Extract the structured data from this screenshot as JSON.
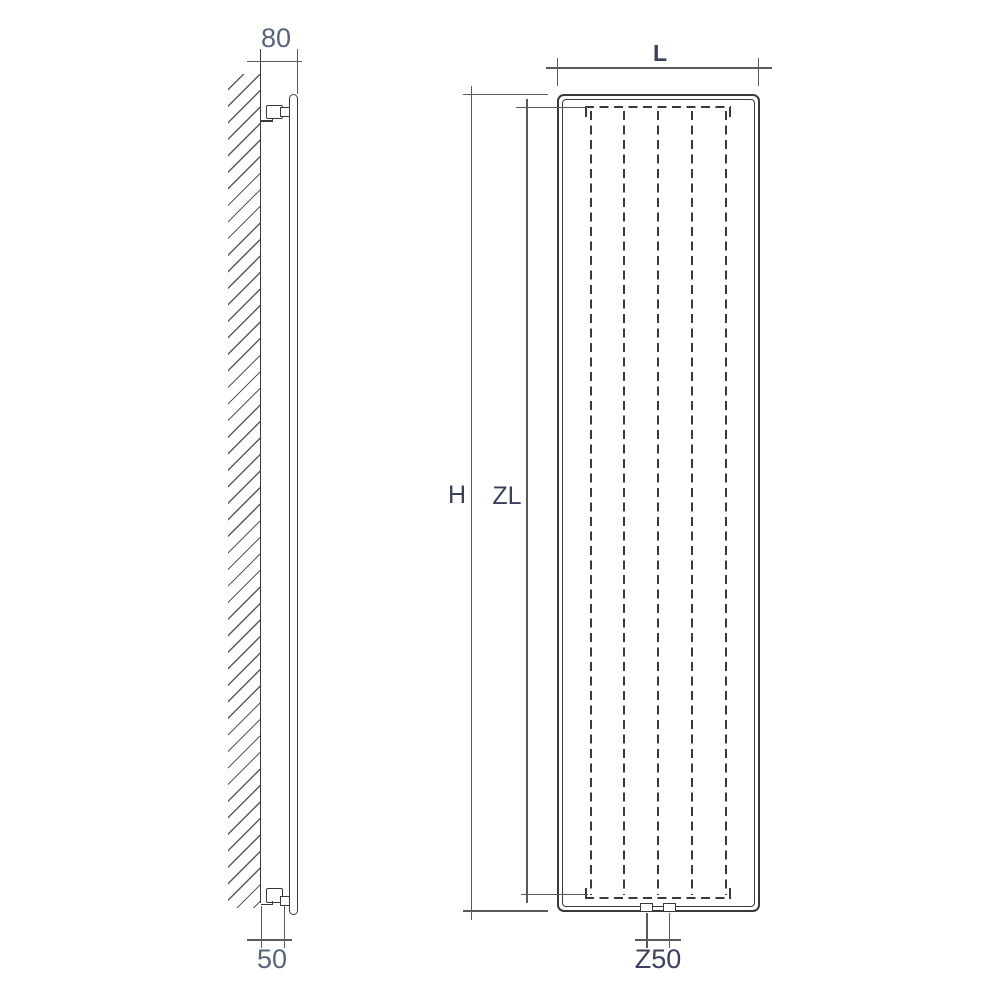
{
  "side_view": {
    "dim_wall_to_front": "80",
    "dim_wall_to_connection": "50"
  },
  "front_view": {
    "dim_total_height": "H",
    "dim_fin_length": "ZL",
    "dim_length": "L",
    "dim_connection_spacing": "Z50"
  },
  "colors": {
    "object_line": "#3a3a3a",
    "dimension_line": "#5a5a5a",
    "label_dark": "#3b3f5e",
    "label_light": "#56657a",
    "background": "#ffffff"
  }
}
